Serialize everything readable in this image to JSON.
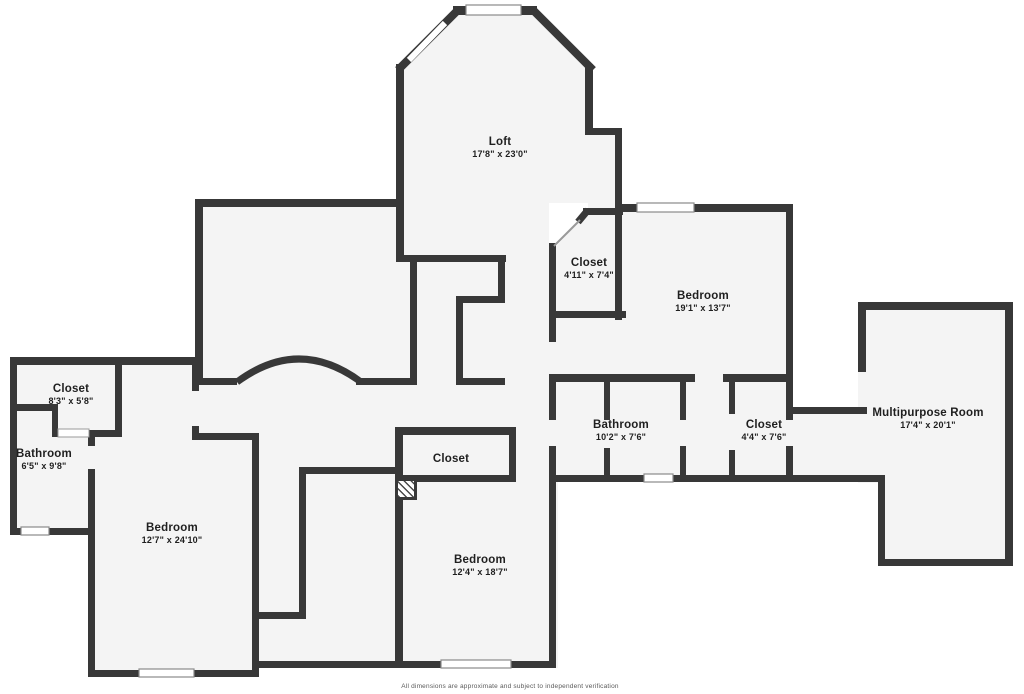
{
  "canvas": {
    "width": 1024,
    "height": 694,
    "bg": "#ffffff",
    "floor_fill": "#f4f4f4",
    "wall_color": "#383838",
    "window_fill": "#ffffff",
    "window_border": "#8a8a8a",
    "door_border": "#9a9a9a",
    "label_color": "#1f1f1f"
  },
  "disclaimer": "All dimensions are approximate and subject to independent verification",
  "rooms": [
    {
      "id": "loft",
      "name": "Loft",
      "dims": "17'8\" x 23'0\"",
      "cx": 500,
      "cy": 148
    },
    {
      "id": "closet-top",
      "name": "Closet",
      "dims": "4'11\" x 7'4\"",
      "cx": 589,
      "cy": 269
    },
    {
      "id": "bedroom-right",
      "name": "Bedroom",
      "dims": "19'1\" x 13'7\"",
      "cx": 703,
      "cy": 302
    },
    {
      "id": "closet-left",
      "name": "Closet",
      "dims": "8'3\" x 5'8\"",
      "cx": 71,
      "cy": 395
    },
    {
      "id": "bathroom-left",
      "name": "Bathroom",
      "dims": "6'5\" x 9'8\"",
      "cx": 44,
      "cy": 460
    },
    {
      "id": "bedroom-left",
      "name": "Bedroom",
      "dims": "12'7\" x 24'10\"",
      "cx": 172,
      "cy": 534
    },
    {
      "id": "closet-center",
      "name": "Closet",
      "dims": "",
      "cx": 451,
      "cy": 459
    },
    {
      "id": "bedroom-center",
      "name": "Bedroom",
      "dims": "12'4\" x 18'7\"",
      "cx": 480,
      "cy": 566
    },
    {
      "id": "bathroom-center",
      "name": "Bathroom",
      "dims": "10'2\" x 7'6\"",
      "cx": 621,
      "cy": 431
    },
    {
      "id": "closet-right",
      "name": "Closet",
      "dims": "4'4\" x 7'6\"",
      "cx": 764,
      "cy": 431
    },
    {
      "id": "multipurpose-room",
      "name": "Multipurpose Room",
      "dims": "17'4\" x 20'1\"",
      "cx": 928,
      "cy": 419
    }
  ],
  "fill_polys": [
    {
      "pts": "401,67 458,10 533,10 590,67 590,131 618,131 618,380 401,380"
    }
  ],
  "fill_rects": [
    {
      "x": 195,
      "y": 200,
      "w": 220,
      "h": 185
    },
    {
      "x": 551,
      "y": 205,
      "w": 242,
      "h": 277
    },
    {
      "x": 793,
      "y": 408,
      "w": 92,
      "h": 74
    },
    {
      "x": 858,
      "y": 303,
      "w": 154,
      "h": 180
    },
    {
      "x": 878,
      "y": 470,
      "w": 134,
      "h": 95
    },
    {
      "x": 10,
      "y": 358,
      "w": 112,
      "h": 82
    },
    {
      "x": 10,
      "y": 430,
      "w": 85,
      "h": 105
    },
    {
      "x": 90,
      "y": 358,
      "w": 168,
      "h": 319
    },
    {
      "x": 258,
      "y": 378,
      "w": 300,
      "h": 290
    }
  ],
  "white_masks": [
    {
      "pts": "549,203 588,203 588,211 554,249 549,249"
    }
  ],
  "walls": [
    {
      "x": 453,
      "y": 6,
      "w": 84,
      "h": 9
    },
    {
      "x": 396,
      "y": 64,
      "w": 8,
      "h": 198
    },
    {
      "x": 585,
      "y": 64,
      "w": 8,
      "h": 71
    },
    {
      "x": 585,
      "y": 128,
      "w": 37,
      "h": 7
    },
    {
      "x": 615,
      "y": 128,
      "w": 7,
      "h": 80
    },
    {
      "x": 195,
      "y": 199,
      "w": 208,
      "h": 8
    },
    {
      "x": 195,
      "y": 199,
      "w": 8,
      "h": 186
    },
    {
      "x": 195,
      "y": 378,
      "w": 42,
      "h": 7
    },
    {
      "x": 356,
      "y": 378,
      "w": 61,
      "h": 7
    },
    {
      "x": 410,
      "y": 258,
      "w": 7,
      "h": 127
    },
    {
      "x": 396,
      "y": 255,
      "w": 110,
      "h": 7
    },
    {
      "x": 498,
      "y": 255,
      "w": 7,
      "h": 48
    },
    {
      "x": 456,
      "y": 296,
      "w": 49,
      "h": 7
    },
    {
      "x": 456,
      "y": 296,
      "w": 7,
      "h": 89
    },
    {
      "x": 456,
      "y": 378,
      "w": 49,
      "h": 7
    },
    {
      "x": 583,
      "y": 208,
      "w": 40,
      "h": 7
    },
    {
      "x": 615,
      "y": 208,
      "w": 7,
      "h": 112
    },
    {
      "x": 549,
      "y": 243,
      "w": 7,
      "h": 99
    },
    {
      "x": 549,
      "y": 311,
      "w": 77,
      "h": 7
    },
    {
      "x": 549,
      "y": 374,
      "w": 146,
      "h": 8
    },
    {
      "x": 723,
      "y": 374,
      "w": 70,
      "h": 8
    },
    {
      "x": 622,
      "y": 204,
      "w": 171,
      "h": 8
    },
    {
      "x": 786,
      "y": 204,
      "w": 7,
      "h": 182
    },
    {
      "x": 549,
      "y": 374,
      "w": 7,
      "h": 46
    },
    {
      "x": 549,
      "y": 446,
      "w": 7,
      "h": 222
    },
    {
      "x": 549,
      "y": 475,
      "w": 244,
      "h": 7
    },
    {
      "x": 604,
      "y": 382,
      "w": 6,
      "h": 38
    },
    {
      "x": 604,
      "y": 448,
      "w": 6,
      "h": 34
    },
    {
      "x": 680,
      "y": 382,
      "w": 6,
      "h": 38
    },
    {
      "x": 680,
      "y": 446,
      "w": 6,
      "h": 36
    },
    {
      "x": 729,
      "y": 382,
      "w": 6,
      "h": 32
    },
    {
      "x": 729,
      "y": 450,
      "w": 6,
      "h": 32
    },
    {
      "x": 786,
      "y": 382,
      "w": 7,
      "h": 38
    },
    {
      "x": 786,
      "y": 446,
      "w": 7,
      "h": 36
    },
    {
      "x": 793,
      "y": 407,
      "w": 74,
      "h": 7
    },
    {
      "x": 793,
      "y": 475,
      "w": 92,
      "h": 7
    },
    {
      "x": 858,
      "y": 302,
      "w": 154,
      "h": 8
    },
    {
      "x": 858,
      "y": 302,
      "w": 8,
      "h": 70
    },
    {
      "x": 1005,
      "y": 302,
      "w": 8,
      "h": 264
    },
    {
      "x": 878,
      "y": 559,
      "w": 134,
      "h": 7
    },
    {
      "x": 878,
      "y": 475,
      "w": 7,
      "h": 91
    },
    {
      "x": 10,
      "y": 357,
      "w": 189,
      "h": 8
    },
    {
      "x": 10,
      "y": 357,
      "w": 7,
      "h": 178
    },
    {
      "x": 115,
      "y": 357,
      "w": 7,
      "h": 80
    },
    {
      "x": 10,
      "y": 404,
      "w": 48,
      "h": 7
    },
    {
      "x": 52,
      "y": 404,
      "w": 6,
      "h": 33
    },
    {
      "x": 88,
      "y": 430,
      "w": 34,
      "h": 7
    },
    {
      "x": 88,
      "y": 430,
      "w": 7,
      "h": 16
    },
    {
      "x": 88,
      "y": 469,
      "w": 7,
      "h": 208
    },
    {
      "x": 10,
      "y": 528,
      "w": 85,
      "h": 7
    },
    {
      "x": 192,
      "y": 357,
      "w": 7,
      "h": 34
    },
    {
      "x": 192,
      "y": 426,
      "w": 7,
      "h": 14
    },
    {
      "x": 192,
      "y": 433,
      "w": 67,
      "h": 7
    },
    {
      "x": 252,
      "y": 433,
      "w": 7,
      "h": 240
    },
    {
      "x": 90,
      "y": 670,
      "w": 169,
      "h": 7
    },
    {
      "x": 252,
      "y": 612,
      "w": 54,
      "h": 7
    },
    {
      "x": 299,
      "y": 470,
      "w": 7,
      "h": 149
    },
    {
      "x": 299,
      "y": 467,
      "w": 99,
      "h": 7
    },
    {
      "x": 252,
      "y": 661,
      "w": 153,
      "h": 7
    },
    {
      "x": 395,
      "y": 427,
      "w": 8,
      "h": 241
    },
    {
      "x": 395,
      "y": 427,
      "w": 121,
      "h": 8
    },
    {
      "x": 509,
      "y": 427,
      "w": 7,
      "h": 55
    },
    {
      "x": 395,
      "y": 475,
      "w": 121,
      "h": 7
    },
    {
      "x": 395,
      "y": 661,
      "w": 161,
      "h": 7
    },
    {
      "x": 549,
      "y": 482,
      "w": 7,
      "h": 186
    }
  ],
  "diagonal_walls": [
    {
      "x1": 398,
      "y1": 70,
      "x2": 459,
      "y2": 9,
      "w": 8
    },
    {
      "x1": 532,
      "y1": 9,
      "x2": 593,
      "y2": 70,
      "w": 8
    },
    {
      "x1": 578,
      "y1": 222,
      "x2": 588,
      "y2": 210,
      "w": 7
    }
  ],
  "diagonal_doors": [
    {
      "x1": 554,
      "y1": 246,
      "x2": 580,
      "y2": 220,
      "w": 2
    }
  ],
  "diagonal_windows": [
    {
      "x1": 409,
      "y1": 60,
      "x2": 445,
      "y2": 23,
      "w": 6
    }
  ],
  "arch": {
    "path": "M 237 382 Q 299 336 361 382",
    "w": 7
  },
  "windows": [
    {
      "x": 466,
      "y": 5,
      "w": 55,
      "h": 10
    },
    {
      "x": 637,
      "y": 203,
      "w": 57,
      "h": 9
    },
    {
      "x": 21,
      "y": 527,
      "w": 28,
      "h": 8
    },
    {
      "x": 139,
      "y": 669,
      "w": 55,
      "h": 8
    },
    {
      "x": 441,
      "y": 660,
      "w": 70,
      "h": 8
    },
    {
      "x": 644,
      "y": 474,
      "w": 29,
      "h": 8
    }
  ],
  "doors": [
    {
      "x": 58,
      "y": 429,
      "w": 31,
      "h": 8
    }
  ],
  "hatch": {
    "x": 395,
    "y": 478,
    "w": 22,
    "h": 22
  }
}
